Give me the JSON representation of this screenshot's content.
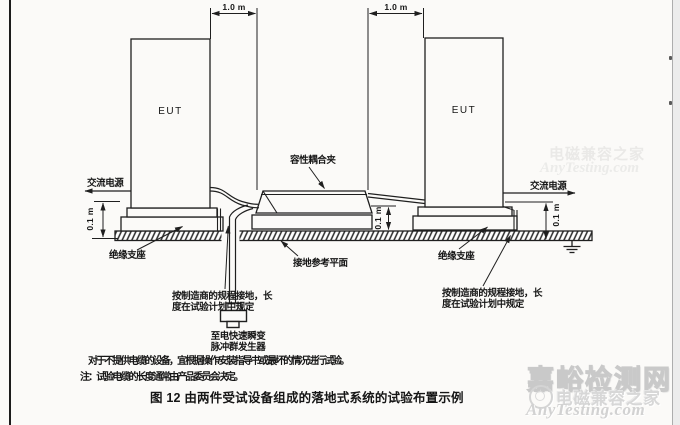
{
  "diagram": {
    "dimensions": {
      "top_left": "1.0 m",
      "top_right": "1.0 m",
      "height_left": "0.1 m",
      "height_middle": "0.1 m",
      "height_right": "0.1 m"
    },
    "labels": {
      "eut_left": "EUT",
      "eut_right": "EUT",
      "ac_power_left": "交流电源",
      "ac_power_right": "交流电源",
      "coupling_clamp": "容性耦合夹",
      "insulating_support_left": "绝缘支座",
      "insulating_support_right": "绝缘支座",
      "ground_reference_plane": "接地参考平面",
      "grounding_note_left_line1": "按制造商的规程接地，长",
      "grounding_note_left_line2": "度在试验计划中规定",
      "grounding_note_right_line1": "按制造商的规程接地，长",
      "grounding_note_right_line2": "度在试验计划中规定",
      "generator_line1": "至电快速瞬变",
      "generator_line2": "脉冲群发生器"
    }
  },
  "notes": {
    "line1": "对于不提供电缆的设备，宜根据操作/安装指导书或最坏的情况进行试验。",
    "line2": "注：试验电缆的长度通常由产品委员会决定。"
  },
  "caption": "图 12  由两件受试设备组成的落地式系统的试验布置示例",
  "watermark": {
    "site_name": "嘉峪检测网",
    "brand_cn": "电磁兼容之家",
    "brand_en": "AnyTesting.com",
    "faint_brand_cn": "电磁兼容之家",
    "faint_brand_en": "AnyTesting.com"
  },
  "colors": {
    "ink": "#1f1f1f",
    "paper": "#fbfaf8",
    "margin_gray": "#ececec",
    "watermark_gray": "#d2d2d2"
  }
}
